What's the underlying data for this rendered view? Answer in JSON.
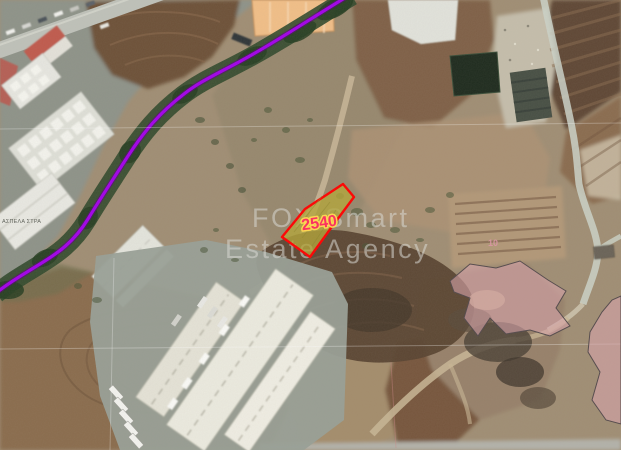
{
  "image": {
    "kind": "aerial-satellite-cadastral-photo",
    "watermark": {
      "line1": "FOX Smart",
      "line2": "Estate Agency",
      "color": "#dadad6"
    },
    "parcel": {
      "number": "2540",
      "fill_color": "#b5a737",
      "outline_color": "#ff0000",
      "number_color": "#ff2d5e",
      "number_halo_color": "#ffd94f"
    },
    "neighbor_parcel": {
      "number": "10",
      "number_color": "#dd96a6"
    },
    "boundary_line": {
      "color": "#a800f2",
      "halo_color": "#5c0080"
    },
    "zoning_overlay": {
      "fill_color": "#d9a3ac",
      "outline_color": "#53494b"
    },
    "building_label": {
      "text": "ΑΣΠΕΛΑ ΣΤΡΑ",
      "color": "#3c4038"
    }
  }
}
